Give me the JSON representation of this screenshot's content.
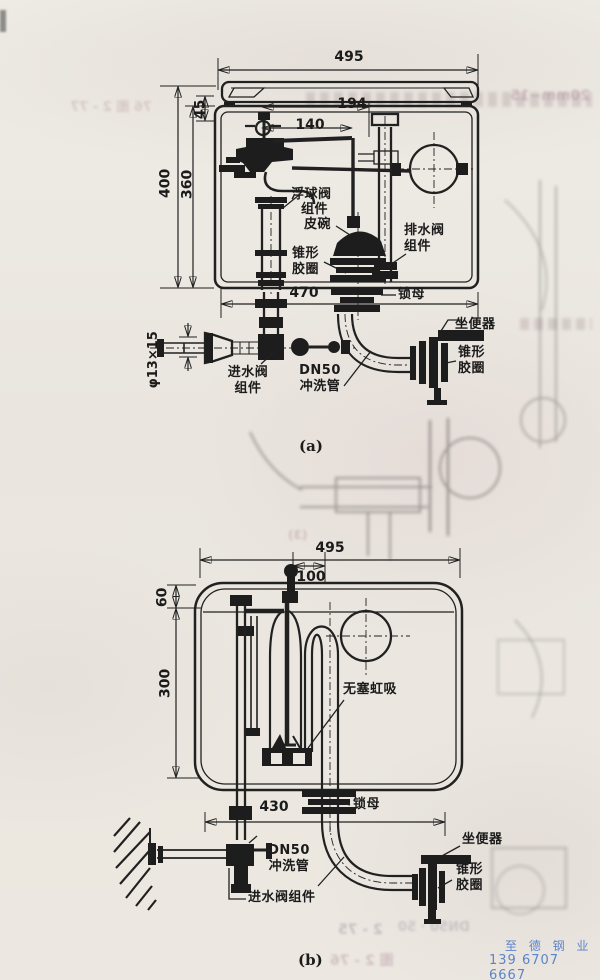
{
  "a": {
    "dims": {
      "width": "495",
      "lid": "45",
      "h_outer": "400",
      "h_inner": "360",
      "arm1": "194",
      "arm2": "140",
      "bottom": "470",
      "inlet_pipe": "φ13×15"
    },
    "labels": {
      "float1": "浮球阀",
      "float2": "组件",
      "cup": "皮碗",
      "cone": "锥形\n胶圈",
      "drain": "排水阀\n组件",
      "locknut": "锁母",
      "toilet": "坐便器",
      "cone2": "锥形\n胶圈",
      "inlet": "进水阀\n组件",
      "flush": "DN50\n冲洗管"
    },
    "caption": "(a)"
  },
  "b": {
    "dims": {
      "width": "495",
      "offset": "100",
      "top": "60",
      "height": "300",
      "bottom": "430"
    },
    "labels": {
      "siphon": "无塞虹吸",
      "locknut": "锁母",
      "toilet": "坐便器",
      "cone": "锥形\n胶圈",
      "flush": "DN50\n冲洗管",
      "inlet": "进水阀组件"
    },
    "caption": "(b)"
  },
  "watermark": {
    "company": "至 德 钢 业",
    "phone": "139 6707 6667",
    "color": "#4b79c8"
  },
  "ghost_fragments": {
    "f1": "20mm−15",
    "f2": "76 图 2 - 77",
    "f3": "2 - 75",
    "f4": "DN50 · 50",
    "f5": "图 2 - 76",
    "f6": "(3)"
  }
}
